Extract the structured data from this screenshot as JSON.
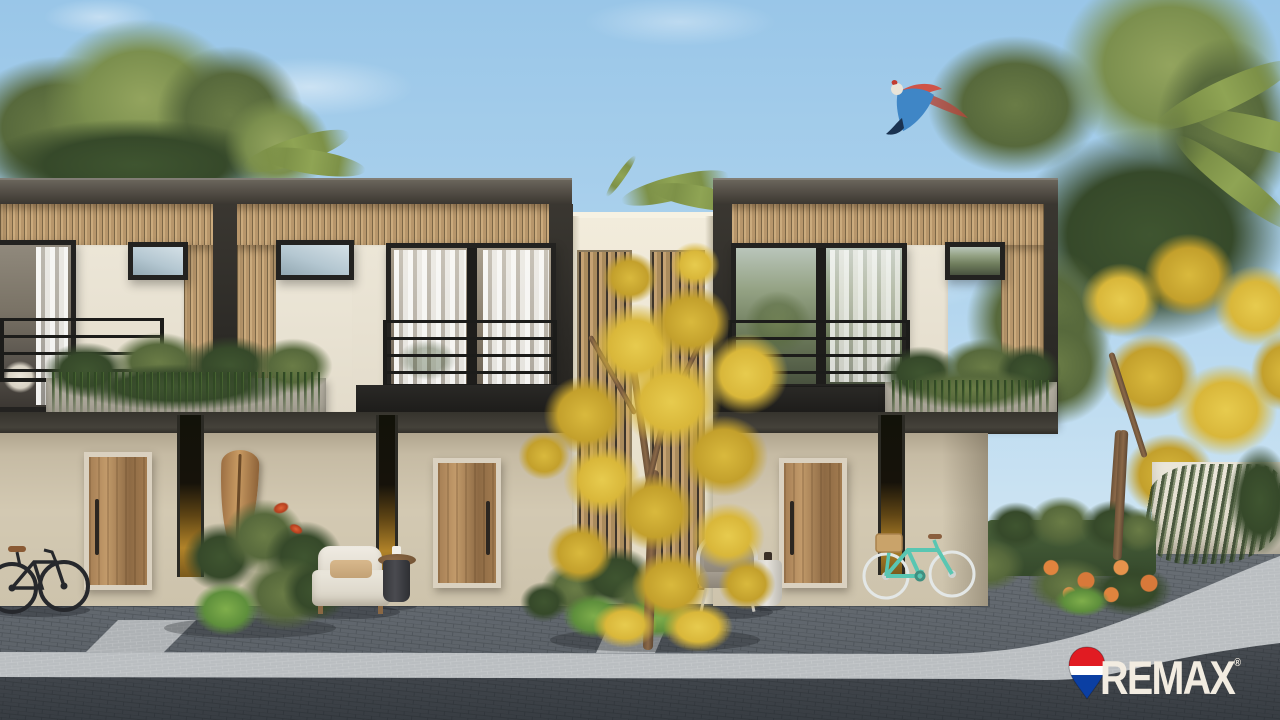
{
  "image": {
    "kind": "architectural rendering photograph",
    "description": "Street view of a modern two-story tropical townhouse row: concrete roof band, wooden slat facade, black framed glass sliding doors with sheer curtains, balconies with hanging plants, beige ground floor with wooden entry doors, a surfboard, lounge chairs, two bicycles, yellow flowering trees, green trees and palms, a flying macaw, and paver street with light walkway"
  },
  "watermark": {
    "brand_text": "REMAX",
    "registered_mark": "®",
    "text_color": "#f2ece1",
    "balloon_icon": "remax-hot-air-balloon",
    "balloon_colors": {
      "top": "#e11b22",
      "band": "#ffffff",
      "bottom": "#0b3fa3"
    }
  },
  "palette": {
    "sky_top": "#99c6e8",
    "sky_horizon": "#d9e9f1",
    "roof_concrete": "#4c473f",
    "wood_slats": "#c7a678",
    "cream_panel": "#eae4d5",
    "ground_wall": "#cdc3ac",
    "window_frame": "#232220",
    "foliage_green": "#57693c",
    "flower_yellow": "#d9b73a",
    "flower_orange": "#d8793a",
    "paver_yard": "#5f656b",
    "walkway_light": "#babec1",
    "street_dark": "#43484e",
    "bicycle_teal": "#59c6b2",
    "door_wood": "#a8815a"
  },
  "objects": [
    "left green trees",
    "right green trees and palms",
    "yellow flowering tree center",
    "yellow flowering tree right",
    "flying macaw",
    "left townhouse unit",
    "right townhouse unit",
    "center recessed wall with wood screens",
    "balcony railings",
    "hanging planter boxes",
    "entry door left",
    "entry door center",
    "entry door right",
    "slot windows with warm light",
    "surfboard",
    "tropical plants",
    "white armchair",
    "dark side table",
    "wicker lounge chair",
    "white side table",
    "black bicycle",
    "teal bicycle with basket",
    "green hedge",
    "orange flower bed",
    "white perimeter wall with vines",
    "paver yard",
    "light walkway",
    "street"
  ]
}
